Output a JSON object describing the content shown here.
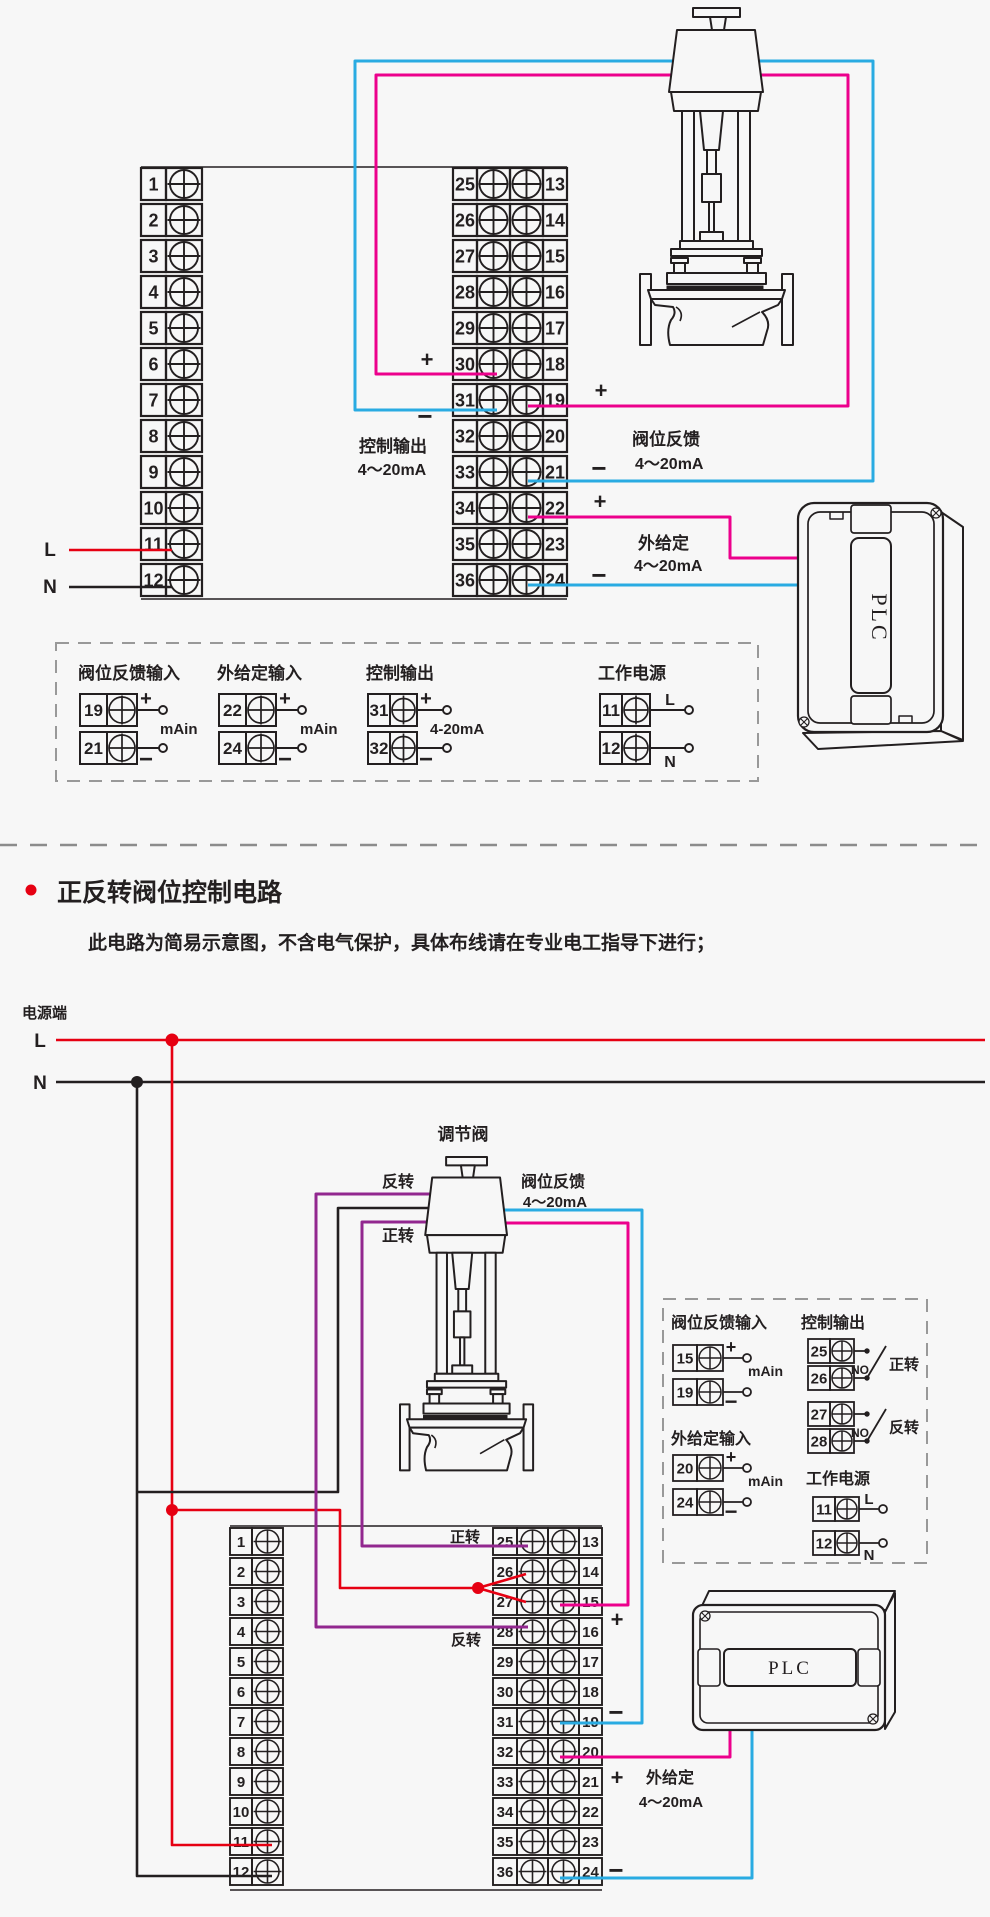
{
  "colors": {
    "background": "#f7f7f7",
    "ink": "#231f20",
    "red": "#e60012",
    "blue": "#29abe2",
    "pink": "#ec008c",
    "purple": "#92278f",
    "dash_gray": "#999999"
  },
  "diagram1": {
    "terminals": {
      "left": [
        "1",
        "2",
        "3",
        "4",
        "5",
        "6",
        "7",
        "8",
        "9",
        "10",
        "11",
        "12"
      ],
      "middle_left": [
        "25",
        "26",
        "27",
        "28",
        "29",
        "30",
        "31",
        "32",
        "33",
        "34",
        "35",
        "36"
      ],
      "middle_right": [
        "13",
        "14",
        "15",
        "16",
        "17",
        "18",
        "19",
        "20",
        "21",
        "22",
        "23",
        "24"
      ]
    },
    "power": {
      "live": "L",
      "neutral": "N"
    },
    "control_output": {
      "title": "控制输出",
      "range": "4～20mA",
      "plus": "+",
      "minus": "−"
    },
    "valve_feedback": {
      "title": "阀位反馈",
      "range": "4～20mA",
      "plus": "+",
      "minus": "−"
    },
    "ext_setpoint": {
      "title": "外给定",
      "range": "4～20mA",
      "plus": "+",
      "minus": "−"
    },
    "plc_label": "PLC",
    "legend": {
      "groups": [
        {
          "title": "阀位反馈输入",
          "unit": "mAin",
          "rows": [
            {
              "terminal": "19",
              "sign": "+"
            },
            {
              "terminal": "21",
              "sign": "−"
            }
          ]
        },
        {
          "title": "外给定输入",
          "unit": "mAin",
          "rows": [
            {
              "terminal": "22",
              "sign": "+"
            },
            {
              "terminal": "24",
              "sign": "−"
            }
          ]
        },
        {
          "title": "控制输出",
          "unit": "4-20mA",
          "rows": [
            {
              "terminal": "31",
              "sign": "+"
            },
            {
              "terminal": "32",
              "sign": "−"
            }
          ]
        },
        {
          "title": "工作电源",
          "unit": "",
          "rows": [
            {
              "terminal": "11",
              "sign": "L"
            },
            {
              "terminal": "12",
              "sign": "N"
            }
          ]
        }
      ]
    }
  },
  "section2": {
    "bullet_title": "正反转阀位控制电路",
    "note": "此电路为简易示意图，不含电气保护，具体布线请在专业电工指导下进行；",
    "power_terminal": "电源端",
    "live": "L",
    "neutral": "N"
  },
  "diagram2": {
    "valve_label": "调节阀",
    "reverse": "反转",
    "forward": "正转",
    "valve_feedback": {
      "title": "阀位反馈",
      "range": "4～20mA"
    },
    "ext_setpoint": {
      "title": "外给定",
      "range": "4～20mA"
    },
    "plc_label": "PLC",
    "signs": {
      "plus": "+",
      "minus": "−"
    },
    "terminals": {
      "left": [
        "1",
        "2",
        "3",
        "4",
        "5",
        "6",
        "7",
        "8",
        "9",
        "10",
        "11",
        "12"
      ],
      "middle_left": [
        "25",
        "26",
        "27",
        "28",
        "29",
        "30",
        "31",
        "32",
        "33",
        "34",
        "35",
        "36"
      ],
      "middle_right": [
        "13",
        "14",
        "15",
        "16",
        "17",
        "18",
        "19",
        "20",
        "21",
        "22",
        "23",
        "24"
      ]
    },
    "legend": {
      "analog_groups": [
        {
          "title": "阀位反馈输入",
          "unit": "mAin",
          "rows": [
            {
              "terminal": "15",
              "sign": "+"
            },
            {
              "terminal": "19",
              "sign": "−"
            }
          ]
        },
        {
          "title": "外给定输入",
          "unit": "mAin",
          "rows": [
            {
              "terminal": "20",
              "sign": "+"
            },
            {
              "terminal": "24",
              "sign": "−"
            }
          ]
        }
      ],
      "control_output": {
        "title": "控制输出",
        "pairs": [
          {
            "a": "25",
            "b": "26",
            "contact": "NO",
            "label": "正转"
          },
          {
            "a": "27",
            "b": "28",
            "contact": "NO",
            "label": "反转"
          }
        ]
      },
      "power": {
        "title": "工作电源",
        "rows": [
          {
            "terminal": "11",
            "sign": "L"
          },
          {
            "terminal": "12",
            "sign": "N"
          }
        ]
      }
    }
  }
}
